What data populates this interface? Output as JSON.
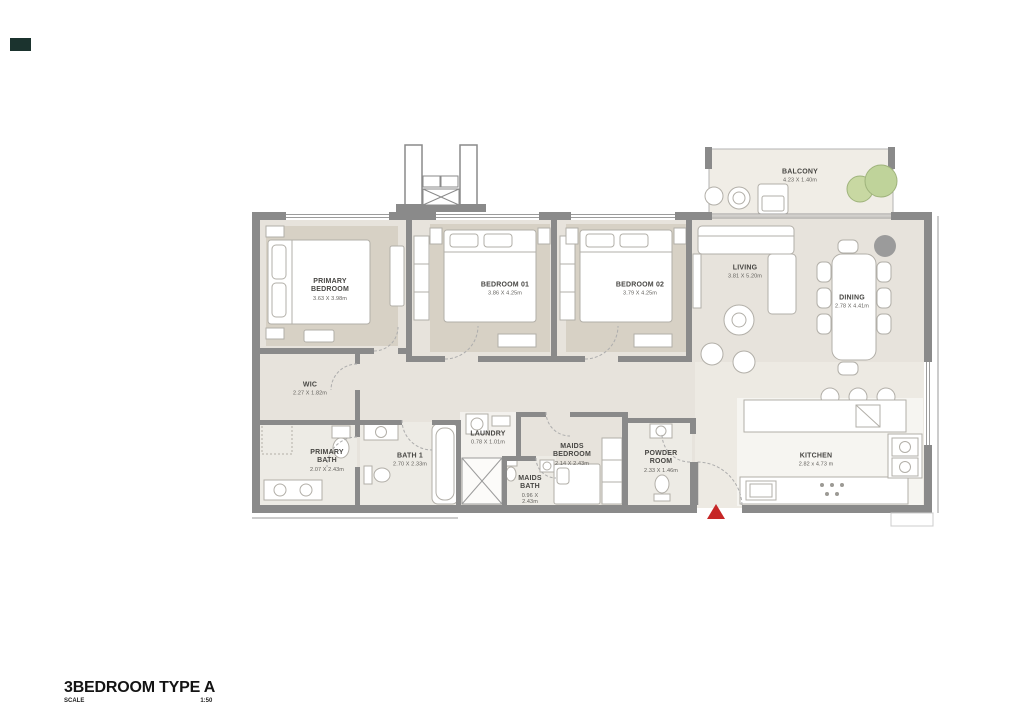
{
  "meta": {
    "title": "3BEDROOM TYPE A",
    "scale_label": "SCALE",
    "scale_value": "1:50"
  },
  "colors": {
    "wall": "#8a8a8a",
    "floor": "#e7e3dc",
    "rug": "#d7d1c5",
    "plant_green": "#c8d8a2",
    "plant_stroke": "#9fb37c",
    "accent_red": "#c62727",
    "column_gray": "#9b9b9b"
  },
  "rooms": [
    {
      "id": "primary-bedroom",
      "name": "PRIMARY BEDROOM",
      "dims": "3.63 X 3.98m"
    },
    {
      "id": "bedroom-01",
      "name": "BEDROOM 01",
      "dims": "3.86 X 4.25m"
    },
    {
      "id": "bedroom-02",
      "name": "BEDROOM 02",
      "dims": "3.79 X 4.25m"
    },
    {
      "id": "living",
      "name": "LIVING",
      "dims": "3.81 X 5.20m"
    },
    {
      "id": "dining",
      "name": "DINING",
      "dims": "2.78 X 4.41m"
    },
    {
      "id": "balcony",
      "name": "BALCONY",
      "dims": "4.23 X 1.40m"
    },
    {
      "id": "wic",
      "name": "WIC",
      "dims": "2.27 X 1.82m"
    },
    {
      "id": "primary-bath",
      "name": "PRIMARY BATH",
      "dims": "2.07 X 2.43m"
    },
    {
      "id": "bath-1",
      "name": "BATH 1",
      "dims": "2.70 X 2.33m"
    },
    {
      "id": "laundry",
      "name": "LAUNDRY",
      "dims": "0.78 X 1.01m"
    },
    {
      "id": "maids-bedroom",
      "name": "MAIDS BEDROOM",
      "dims": "2.14 X 2.43m"
    },
    {
      "id": "maids-bath",
      "name": "MAIDS BATH",
      "dims": "0.96 X 2.43m"
    },
    {
      "id": "powder-room",
      "name": "POWDER ROOM",
      "dims": "2.33 X 1.46m"
    },
    {
      "id": "kitchen",
      "name": "KITCHEN",
      "dims": "2.82 x 4.73 m"
    }
  ]
}
